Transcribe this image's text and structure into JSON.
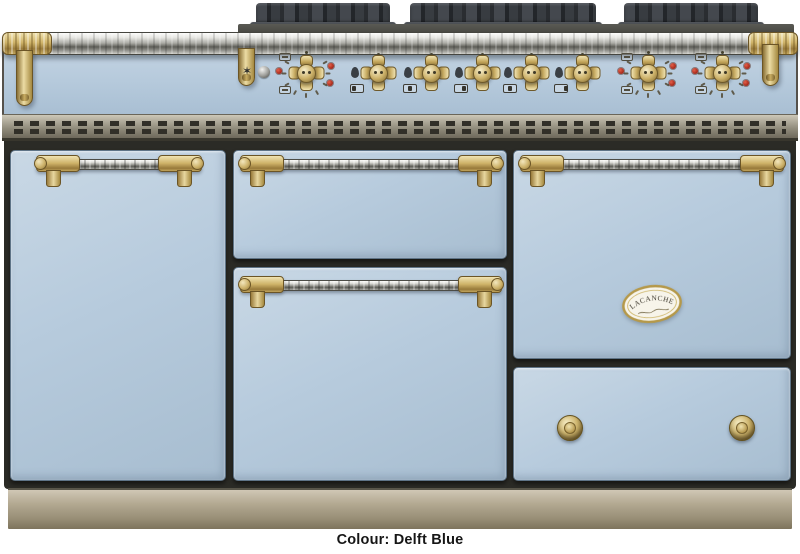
{
  "caption": "Colour: Delft Blue",
  "product": {
    "brand": "Lacanche",
    "badge": {
      "title": "LACANCHE"
    }
  },
  "colors": {
    "delft_blue": "#b7cbdd",
    "brass": "#cfb369",
    "chrome": "#c6c6c2",
    "grate_iron": "#383c41",
    "vent_steel": "#8f8a7a",
    "plinth": "#a99f8a",
    "body_frame": "#2b2b26",
    "indicator_red": "#b5372a",
    "background": "#ffffff",
    "caption_text": "#161616"
  },
  "cooktop": {
    "grates": [
      "left-grate",
      "center-grate",
      "right-grate"
    ]
  },
  "control_panel": {
    "knobs": [
      {
        "id": "oven-knob-left",
        "kind": "oven"
      },
      {
        "id": "burner-knob-1",
        "kind": "burner"
      },
      {
        "id": "burner-knob-2",
        "kind": "burner"
      },
      {
        "id": "burner-knob-3",
        "kind": "burner"
      },
      {
        "id": "burner-knob-4",
        "kind": "burner"
      },
      {
        "id": "burner-knob-5",
        "kind": "burner"
      },
      {
        "id": "oven-knob-center",
        "kind": "oven"
      },
      {
        "id": "oven-knob-right",
        "kind": "oven"
      }
    ],
    "icons": {
      "star-icon": "✶",
      "ignition-icon": "metal-sphere",
      "flame-icon": "gas-flame-drop",
      "burner-selector-icon": "hob-position-box",
      "indicator-light": "red-dot"
    }
  },
  "doors": [
    {
      "id": "left-cupboard-door",
      "handle": "rail-handle"
    },
    {
      "id": "middle-top-drawer",
      "handle": "rail-handle"
    },
    {
      "id": "middle-oven-door",
      "handle": "rail-handle"
    },
    {
      "id": "right-oven-door",
      "handle": "rail-handle",
      "badge": "LACANCHE"
    },
    {
      "id": "bottom-right-drawer",
      "knobs": 2
    }
  ]
}
